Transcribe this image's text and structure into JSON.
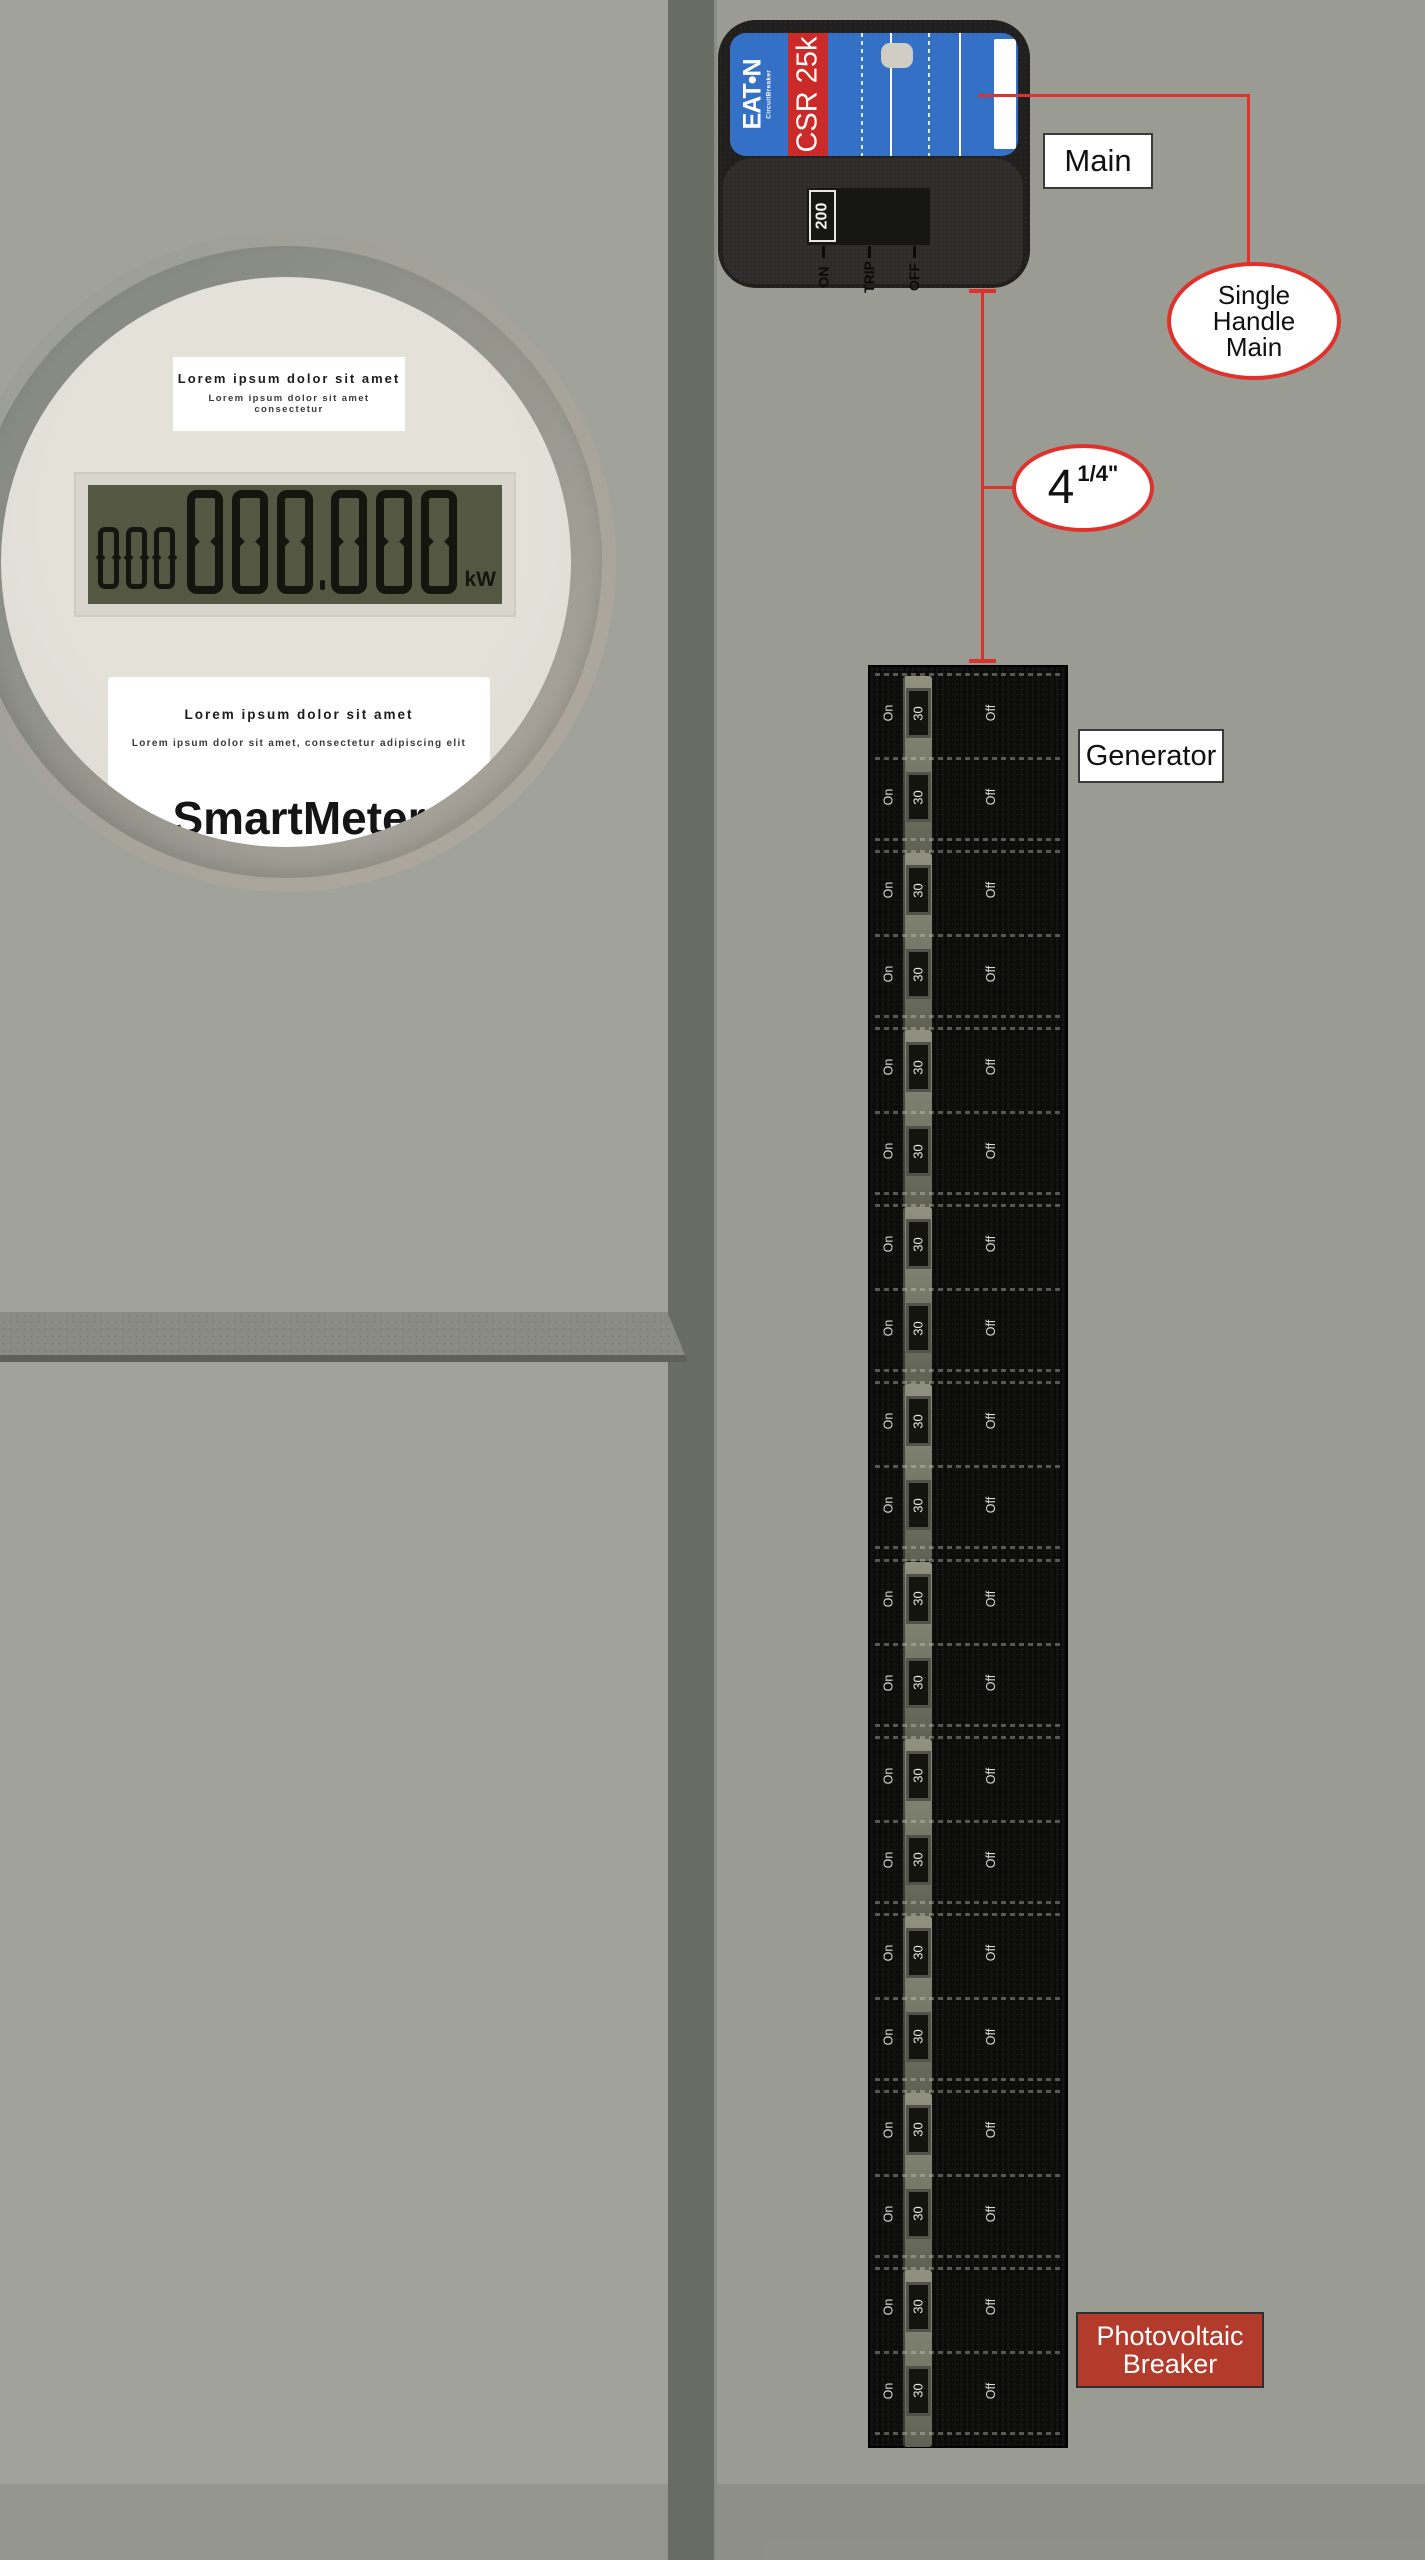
{
  "meter": {
    "top_label": {
      "line1": "Lorem ipsum dolor sit amet",
      "line2": "Lorem ipsum dolor sit amet consectetur"
    },
    "lcd": {
      "small_digits": "000",
      "big_digits_int": "000",
      "big_digits_frac": "000",
      "unit": "kW"
    },
    "bottom_label": {
      "line1": "Lorem ipsum dolor sit amet",
      "line2": "Lorem ipsum dolor sit amet, consectetur adipiscing elit",
      "brand": "SmartMeter"
    }
  },
  "main_breaker": {
    "brand": "EAT•N",
    "brand_sub": "CircuitBreaker",
    "model": "CSR 25k",
    "rating": "200",
    "positions": [
      "ON",
      "TRIP",
      "OFF"
    ]
  },
  "labels": {
    "main": "Main",
    "generator": "Generator",
    "pv_line1": "Photovoltaic",
    "pv_line2": "Breaker"
  },
  "callouts": {
    "single_handle": [
      "Single",
      "Handle",
      "Main"
    ],
    "dimension_value": "4",
    "dimension_fraction": "1/4\""
  },
  "panel": {
    "group_count": 10,
    "rows_per_group": 2,
    "on_label": "On",
    "amp_label": "30",
    "off_label": "Off"
  },
  "colors": {
    "callout_red": "#e0312b",
    "eaton_blue": "#3470c5",
    "model_stripe_red": "#cb2b28",
    "pv_label_red": "#b23b2b",
    "lcd_green": "#545843",
    "wall_left": "#a1a39b",
    "wall_right": "#9a9c94",
    "wall_stripe": "#696c63"
  }
}
